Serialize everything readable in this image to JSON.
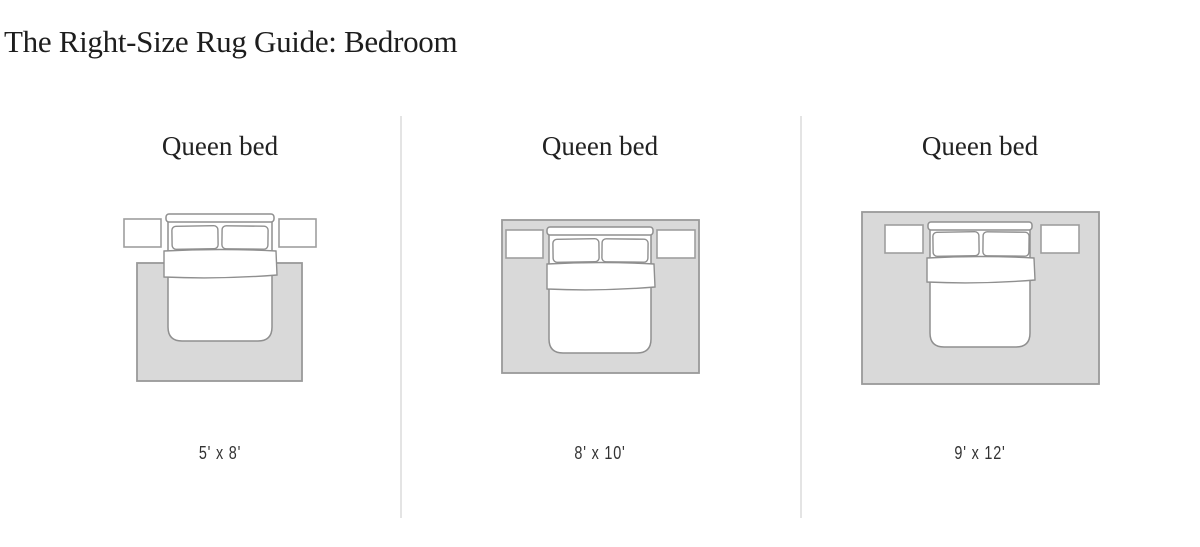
{
  "title": "The Right-Size Rug Guide: Bedroom",
  "panels": [
    {
      "bed_label": "Queen bed",
      "rug_size": "5' x 8'"
    },
    {
      "bed_label": "Queen bed",
      "rug_size": "8' x 10'"
    },
    {
      "bed_label": "Queen bed",
      "rug_size": "9' x 12'"
    }
  ],
  "colors": {
    "rug_fill": "#d9d9d9",
    "rug_border": "#999999",
    "bed_line": "#8f8f8f",
    "nightstand_border": "#9e9e9e",
    "divider": "#e4e4e4",
    "title_text": "#1d1d1d",
    "label_text": "#333333"
  }
}
